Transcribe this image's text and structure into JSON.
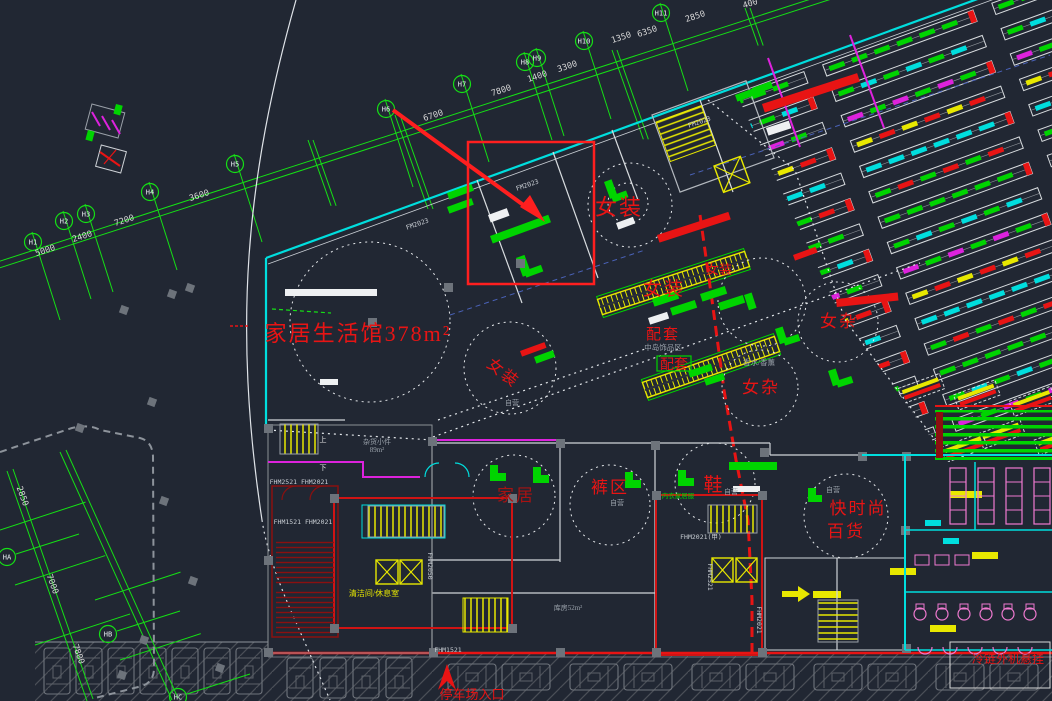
{
  "meta": {
    "drawing": "mall-first-floor-cad-plan",
    "canvas_w": 1052,
    "canvas_h": 701
  },
  "colors": {
    "bg": "#212733",
    "bg_parking": "#242932",
    "hatch": "#4a4f57",
    "grid_green": "#15e015",
    "wall_cyan": "#00dede",
    "white": "#e6e6e6",
    "wall_gray": "#9ba1a9",
    "gray_text": "#9aa2ab",
    "dim_text": "#d8d8d8",
    "red": "#e81414",
    "red_bright": "#ff1f1f",
    "red_dark": "#a81212",
    "esc_red": "#8a1010",
    "yellow": "#e8e800",
    "magenta": "#dd22dd",
    "pink": "#f07ad0",
    "green": "#00d400",
    "column": "#6d737b",
    "road": "#8d939b",
    "blue": "#4a62b8"
  },
  "area_labels": [
    {
      "text": "家居生活馆378m²",
      "x": 358,
      "y": 341,
      "size": 22,
      "color": "red",
      "rot": 0
    },
    {
      "text": "女装",
      "x": 619,
      "y": 215,
      "size": 22,
      "color": "red",
      "rot": 0
    },
    {
      "text": "女装",
      "x": 664,
      "y": 295,
      "size": 19,
      "color": "red",
      "rot": 0
    },
    {
      "text": "女装",
      "x": 719,
      "y": 274,
      "size": 13,
      "color": "red",
      "rot": 0
    },
    {
      "text": "女装",
      "x": 500,
      "y": 377,
      "size": 16,
      "color": "red",
      "rot": 38
    },
    {
      "text": "女杂",
      "x": 839,
      "y": 327,
      "size": 17,
      "color": "red",
      "rot": 0
    },
    {
      "text": "女杂",
      "x": 761,
      "y": 393,
      "size": 17,
      "color": "red",
      "rot": 0
    },
    {
      "text": "配套",
      "x": 663,
      "y": 339,
      "size": 15,
      "color": "red",
      "rot": 0
    },
    {
      "text": "配套",
      "x": 674,
      "y": 369,
      "size": 14,
      "color": "red",
      "rot": 0
    },
    {
      "text": "家居",
      "x": 516,
      "y": 501,
      "size": 17,
      "color": "red_dark",
      "rot": 0
    },
    {
      "text": "裤区",
      "x": 610,
      "y": 493,
      "size": 17,
      "color": "red",
      "rot": 0
    },
    {
      "text": "鞋",
      "x": 714,
      "y": 491,
      "size": 19,
      "color": "red",
      "rot": 0
    },
    {
      "text": "快时尚",
      "x": 858,
      "y": 514,
      "size": 17,
      "color": "red",
      "rot": 0
    },
    {
      "text": "百货",
      "x": 846,
      "y": 537,
      "size": 17,
      "color": "red",
      "rot": 0
    },
    {
      "text": "停车场入口",
      "x": 472,
      "y": 699,
      "size": 13,
      "color": "red",
      "rot": 0
    },
    {
      "text": "冷链外机悬挂",
      "x": 1008,
      "y": 663,
      "size": 12,
      "color": "red",
      "rot": 0
    },
    {
      "text": "清洁间/休息室",
      "x": 374,
      "y": 596,
      "size": 8,
      "color": "yellow",
      "rot": 0
    },
    {
      "text": "香水/香薰",
      "x": 759,
      "y": 365,
      "size": 7.5,
      "color": "gray_text",
      "rot": 0
    },
    {
      "text": "中岛饰品区",
      "x": 663,
      "y": 350,
      "size": 7.5,
      "color": "gray_text",
      "rot": 0
    },
    {
      "text": "自营",
      "x": 617,
      "y": 505,
      "size": 7,
      "color": "gray_text",
      "rot": 0
    },
    {
      "text": "自营",
      "x": 731,
      "y": 494,
      "size": 7,
      "color": "gray_text",
      "rot": 0
    },
    {
      "text": "自营",
      "x": 833,
      "y": 492,
      "size": 7,
      "color": "gray_text",
      "rot": 0
    },
    {
      "text": "自营",
      "x": 512,
      "y": 405,
      "size": 7,
      "color": "gray_text",
      "rot": 0
    },
    {
      "text": "杂货小件",
      "x": 377,
      "y": 444,
      "size": 7,
      "color": "gray_text",
      "rot": 0
    },
    {
      "text": "89m²",
      "x": 377,
      "y": 452,
      "size": 7,
      "color": "gray_text",
      "rot": 0
    },
    {
      "text": "库房52m²",
      "x": 568,
      "y": 610,
      "size": 7,
      "color": "gray_text",
      "rot": 0
    },
    {
      "text": "上",
      "x": 323,
      "y": 442,
      "size": 7,
      "color": "white",
      "rot": 0
    },
    {
      "text": "下",
      "x": 323,
      "y": 470,
      "size": 7,
      "color": "white",
      "rot": 0
    },
    {
      "text": "内衣家居服",
      "x": 678,
      "y": 498,
      "size": 6.5,
      "color": "green",
      "rot": 0
    }
  ],
  "door_codes": [
    {
      "text": "FM2023",
      "x": 418,
      "y": 226,
      "rot": -19
    },
    {
      "text": "FM2023",
      "x": 528,
      "y": 187,
      "rot": -19
    },
    {
      "text": "FM2023",
      "x": 700,
      "y": 124,
      "rot": -19
    },
    {
      "text": "FHM2521 FHM2021",
      "x": 299,
      "y": 484,
      "rot": 0
    },
    {
      "text": "FHM1521 FHM2021",
      "x": 303,
      "y": 524,
      "rot": 0
    },
    {
      "text": "FHM2021(甲)",
      "x": 701,
      "y": 539,
      "rot": 0
    },
    {
      "text": "FHM2050",
      "x": 428,
      "y": 566,
      "rot": 90
    },
    {
      "text": "FHM2521",
      "x": 708,
      "y": 577,
      "rot": 90
    },
    {
      "text": "FHM2021",
      "x": 757,
      "y": 620,
      "rot": 90
    },
    {
      "text": "FHM1521",
      "x": 448,
      "y": 652,
      "rot": 0
    }
  ],
  "grid": {
    "bubbles": [
      {
        "label": "H1",
        "x": 33,
        "y": 242
      },
      {
        "label": "H2",
        "x": 64,
        "y": 221
      },
      {
        "label": "H3",
        "x": 86,
        "y": 214
      },
      {
        "label": "H4",
        "x": 150,
        "y": 192
      },
      {
        "label": "H5",
        "x": 235,
        "y": 164
      },
      {
        "label": "H6",
        "x": 386,
        "y": 109
      },
      {
        "label": "H7",
        "x": 462,
        "y": 84
      },
      {
        "label": "H8",
        "x": 525,
        "y": 62
      },
      {
        "label": "H9",
        "x": 537,
        "y": 58
      },
      {
        "label": "H10",
        "x": 584,
        "y": 41
      },
      {
        "label": "H11",
        "x": 661,
        "y": 13
      },
      {
        "label": "HA",
        "x": 7,
        "y": 557
      },
      {
        "label": "HB",
        "x": 108,
        "y": 634
      },
      {
        "label": "HC",
        "x": 178,
        "y": 697
      }
    ],
    "dims": [
      {
        "text": "5000",
        "x": 46,
        "y": 253,
        "rot": -18
      },
      {
        "text": "2400",
        "x": 83,
        "y": 239,
        "rot": -18
      },
      {
        "text": "7200",
        "x": 125,
        "y": 223,
        "rot": -18
      },
      {
        "text": "3600",
        "x": 200,
        "y": 198,
        "rot": -18
      },
      {
        "text": "6700",
        "x": 434,
        "y": 118,
        "rot": -18
      },
      {
        "text": "7800",
        "x": 502,
        "y": 93,
        "rot": -18
      },
      {
        "text": "1400",
        "x": 538,
        "y": 79,
        "rot": -18
      },
      {
        "text": "3300",
        "x": 568,
        "y": 69,
        "rot": -18
      },
      {
        "text": "1350",
        "x": 622,
        "y": 40,
        "rot": -18
      },
      {
        "text": "6350",
        "x": 648,
        "y": 34,
        "rot": -18
      },
      {
        "text": "2850",
        "x": 696,
        "y": 19,
        "rot": -18
      },
      {
        "text": "400",
        "x": 751,
        "y": 6,
        "rot": -18
      },
      {
        "text": "2850",
        "x": 20,
        "y": 497,
        "rot": 70
      },
      {
        "text": "7000",
        "x": 50,
        "y": 585,
        "rot": 70
      },
      {
        "text": "7800",
        "x": 76,
        "y": 655,
        "rot": 70
      }
    ]
  }
}
